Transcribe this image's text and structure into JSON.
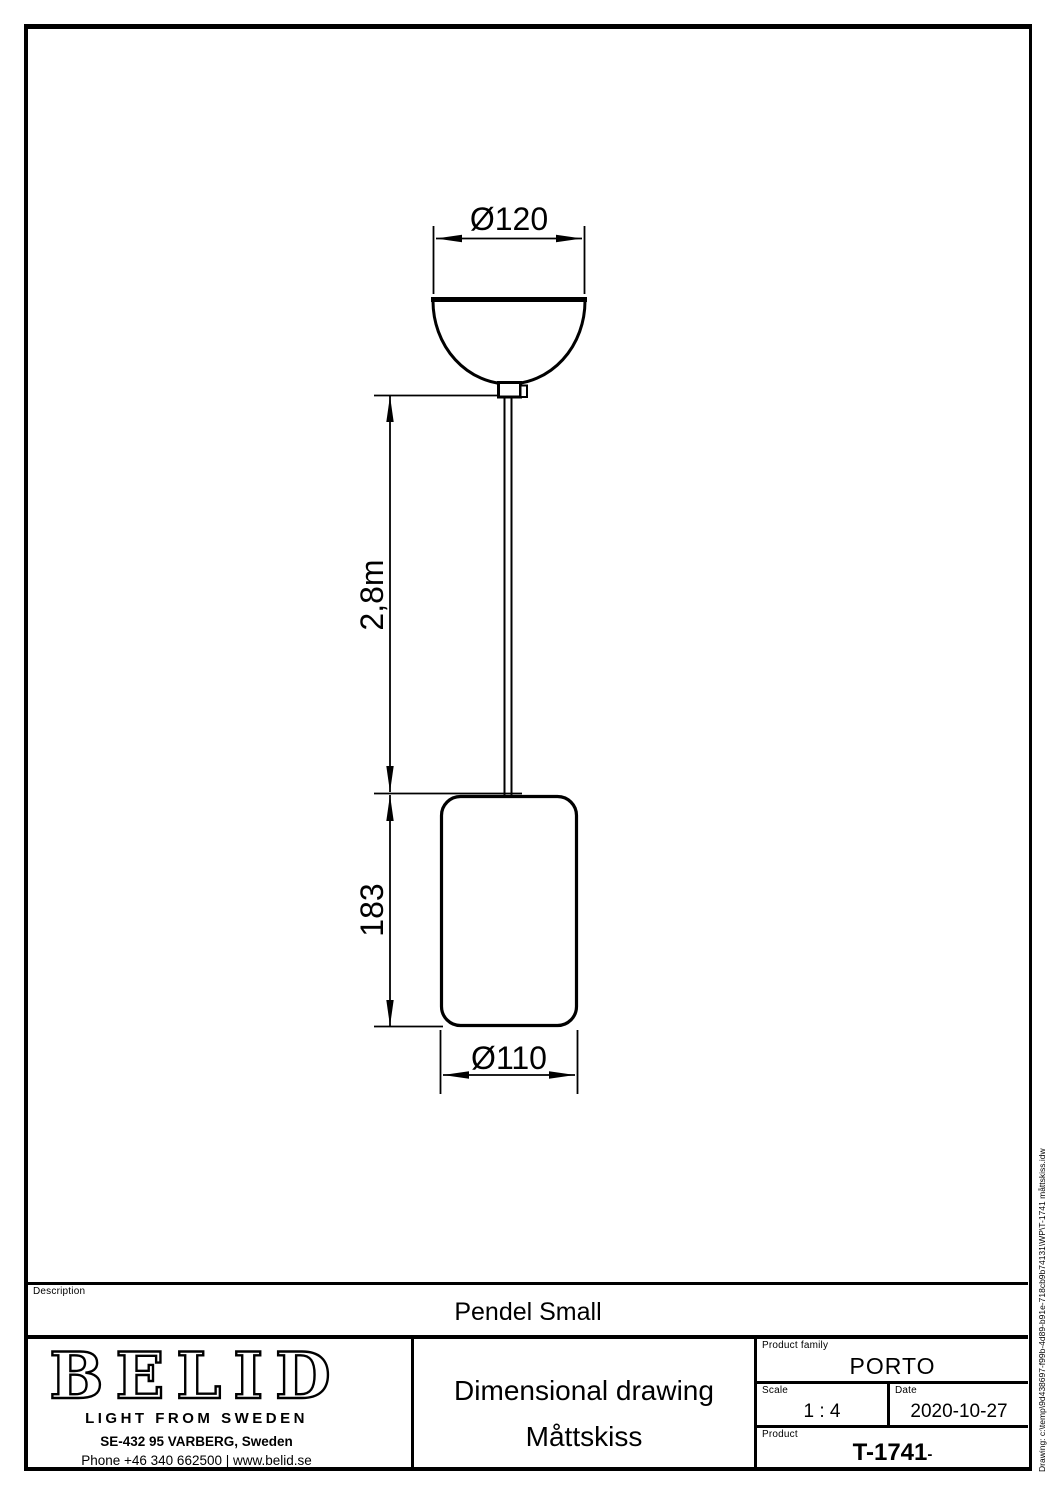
{
  "colors": {
    "line": "#000000",
    "background": "#ffffff"
  },
  "drawing": {
    "dimensions": {
      "canopy_diameter": "Ø120",
      "cord_length": "2,8m",
      "shade_height": "183",
      "shade_diameter": "Ø110"
    }
  },
  "title_block": {
    "description_label": "Description",
    "description_value": "Pendel Small",
    "doc_type_en": "Dimensional drawing",
    "doc_type_sv": "Måttskiss",
    "product_family_label": "Product family",
    "product_family_value": "PORTO",
    "scale_label": "Scale",
    "scale_value": "1 : 4",
    "date_label": "Date",
    "date_value": "2020-10-27",
    "product_label": "Product",
    "product_value": "T-1741",
    "product_value_suffix": "-"
  },
  "brand": {
    "logo_text": "BELID",
    "tagline": "LIGHT FROM SWEDEN",
    "address": "SE-432 95 VARBERG, Sweden",
    "contact": "Phone +46 340 662500 | www.belid.se"
  },
  "side_note": "Drawing: c:\\temp\\9d438697-f99b-4d89-b91e-718cb9b74131\\WP\\T-1741 måttskiss.idw"
}
